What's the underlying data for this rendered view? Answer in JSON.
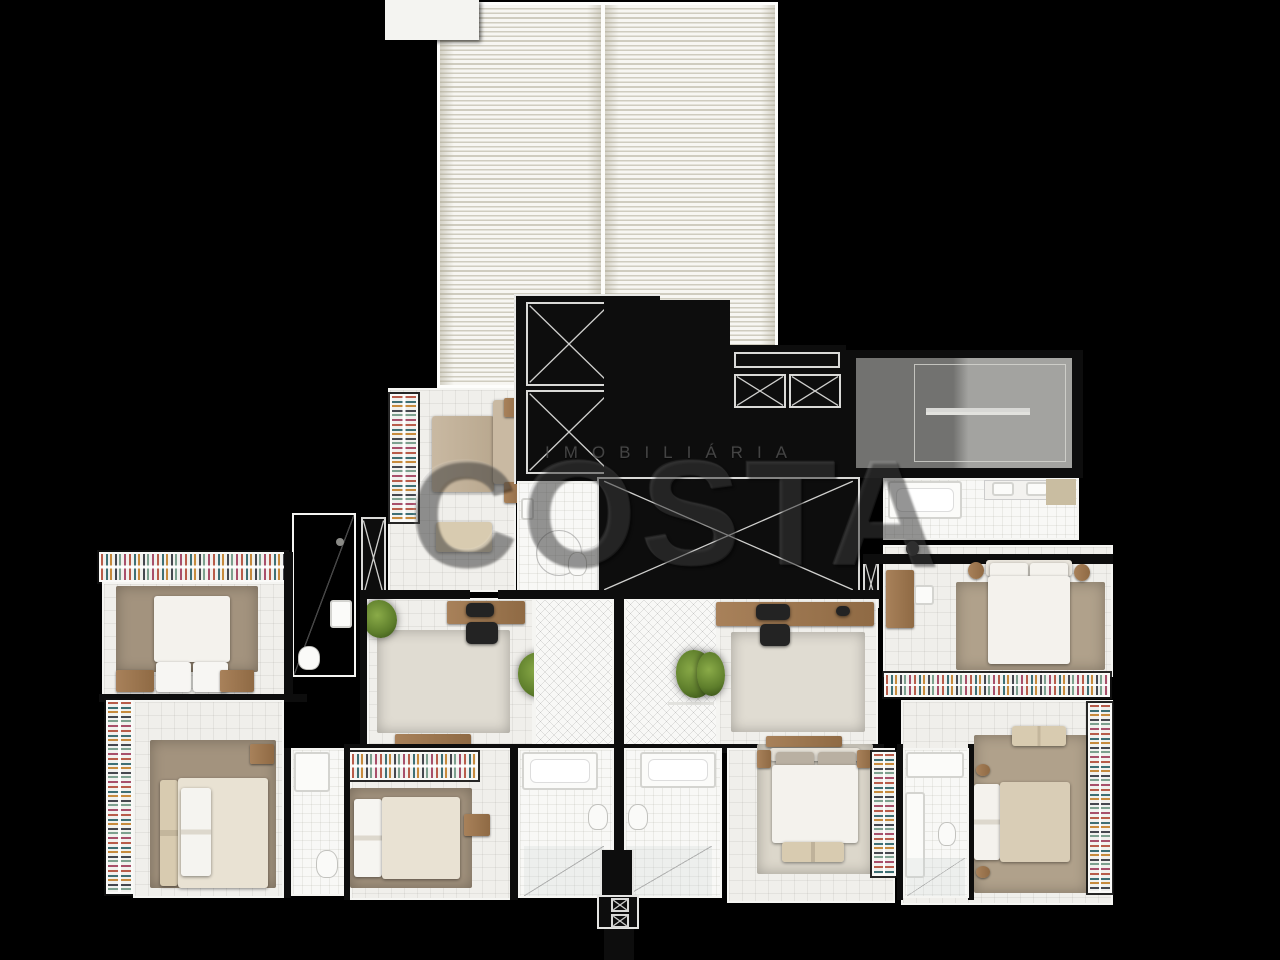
{
  "watermark": {
    "brand_line": "IMOBILIÁRIA",
    "brand_name": "COSTA"
  },
  "palette": {
    "bg": "#000000",
    "wall": "#0d0d0d",
    "wall_edge": "#f5f5f2",
    "floor": "#f0efeb",
    "floor_bright": "#f8f8f6",
    "slat_bg": "#f7f6f2",
    "slat_line": "#cfccbf",
    "rug_taupe": "#a3937e",
    "rug_tan": "#b0a18b",
    "rug_pale": "#e0dcd2",
    "rug_gray": "#dcd7cb",
    "wood": "#a8815a",
    "wood_dark": "#8f6a44",
    "bed_white": "#f4f2ed",
    "duvet_cream": "#e9e2d3",
    "duvet_tan": "#d9cdb6",
    "sofa": "#c9b9a2",
    "cushion": "#d8cbb0",
    "pillow_gray": "#b9b0a2",
    "plant": "#5d7d2b",
    "plant_light": "#8aab48",
    "stairs_dark": "#727270",
    "stairs_light": "#a3a3a0",
    "strip_bg": "#f1f1ee"
  }
}
